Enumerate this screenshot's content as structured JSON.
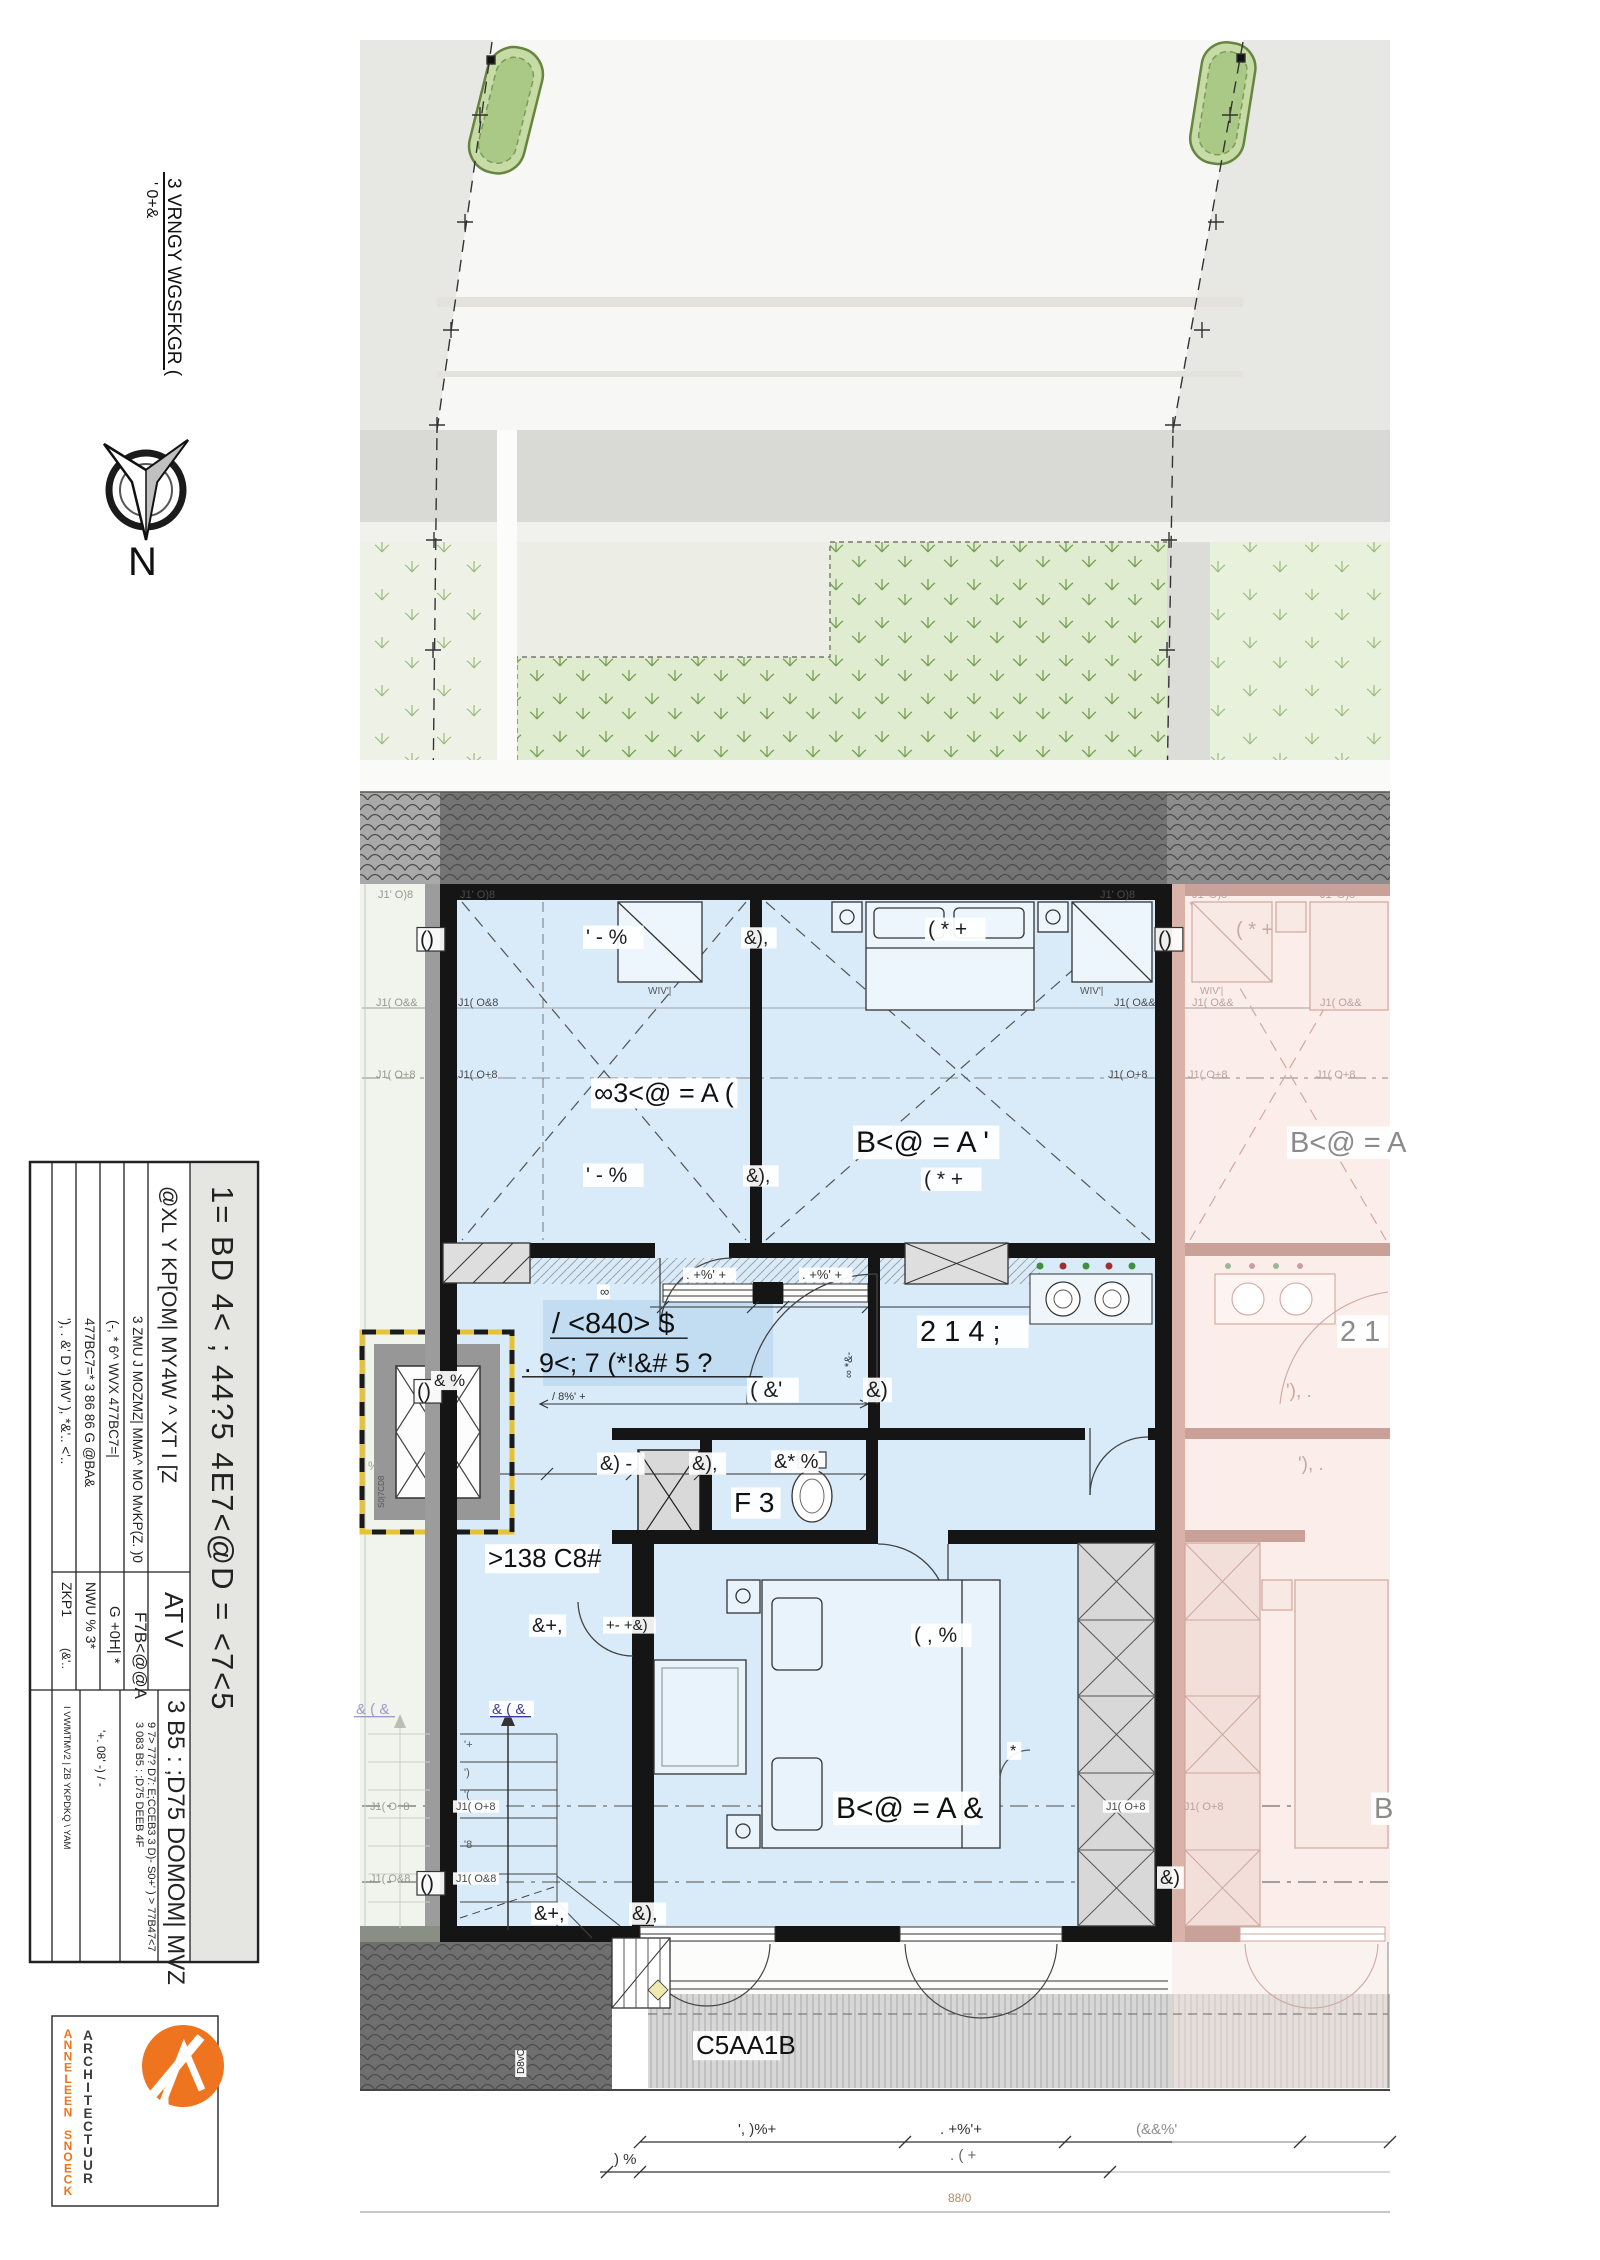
{
  "header": {
    "note1": "3 VRNGY WGSFKGR (",
    "note2": "' 0+&",
    "north_label": "N"
  },
  "colors": {
    "accent_orange": "#ee7420",
    "unit_highlight_blue": "#d9ebf9",
    "hall_highlight_blue": "#c2ddf2",
    "neighbor_pink": "#fbeeea",
    "garden_green": "#dfecd0",
    "dim_blue": "#3a3a9c"
  },
  "title_block": {
    "project_title": "1= BD 4< ;  44?5 4E7<@D = <7<5",
    "rows": [
      {
        "label": "@XL Y KP[OM| MY4W ^ XT I [Z",
        "value": "AT V"
      },
      {
        "label": "3 ZMU J MOZMZ| MMA^ MO MvKP(Z. )0",
        "value": "F7B<@@A"
      },
      {
        "label": "(-, * 6^ WVX  477BC7=|",
        "value": "G +0H| *"
      },
      {
        "label": "477BC7=* 3 86 86 G @BA&",
        "value": "NWU % 3*"
      },
      {
        "label": "'), . &' D ') MV' ), *&'.. <'..",
        "value": "ZKP1",
        "value2": "(&'.."
      }
    ],
    "drawing_title": "3 B5 : ;D75 DOMOM| MVZ",
    "notes": [
      "3 083 B5 : ;D75 DEEB 4F",
      "9 7> 77? D7: E;CCEB3 3 D)- S0+' ) > 77B47<7",
      "'+. 08' -) / -"
    ],
    "side_note": "I VWMTMV2 | ZB YKPDKQ \\ YAM"
  },
  "logo": {
    "studio": "ARCHITECTUUR",
    "architect": "ANNELEEN SNOECK"
  },
  "plan": {
    "annotations": [
      {
        "n": "wall-label",
        "x": 378,
        "y": 898,
        "t": "J1' O)8",
        "s": 11,
        "c": "#949a8e"
      },
      {
        "n": "wall-label",
        "x": 460,
        "y": 898,
        "t": "J1' O)8",
        "s": 11,
        "c": "#4a4a4a"
      },
      {
        "n": "wall-label",
        "x": 1100,
        "y": 898,
        "t": "J1' O)8",
        "s": 11,
        "c": "#4a4a4a"
      },
      {
        "n": "wall-label",
        "x": 1192,
        "y": 898,
        "t": "J1' O)8",
        "s": 11,
        "c": "#bca29a"
      },
      {
        "n": "wall-label",
        "x": 1320,
        "y": 898,
        "t": "J1' O)8",
        "s": 11,
        "c": "#bca29a"
      },
      {
        "n": "wall-label",
        "x": 376,
        "y": 1006,
        "t": "J1( O&&",
        "s": 11,
        "c": "#949a8e"
      },
      {
        "n": "wall-label",
        "x": 458,
        "y": 1006,
        "t": "J1( O&8",
        "s": 11,
        "c": "#4a4a4a"
      },
      {
        "n": "wall-label",
        "x": 1114,
        "y": 1006,
        "t": "J1( O&&",
        "s": 11,
        "c": "#4a4a4a"
      },
      {
        "n": "wall-label",
        "x": 1192,
        "y": 1006,
        "t": "J1( O&&",
        "s": 11,
        "c": "#bca29a"
      },
      {
        "n": "wall-label",
        "x": 1320,
        "y": 1006,
        "t": "J1( O&&",
        "s": 11,
        "c": "#bca29a"
      },
      {
        "n": "wall-label",
        "x": 376,
        "y": 1078,
        "t": "J1( O+8",
        "s": 11,
        "c": "#949a8e"
      },
      {
        "n": "wall-label",
        "x": 458,
        "y": 1078,
        "t": "J1( O+8",
        "s": 11,
        "c": "#4a4a4a"
      },
      {
        "n": "wall-label",
        "x": 1108,
        "y": 1078,
        "t": "J1( O+8",
        "s": 11,
        "c": "#4a4a4a"
      },
      {
        "n": "wall-label",
        "x": 1188,
        "y": 1078,
        "t": "J1( O+8",
        "s": 11,
        "c": "#bca29a"
      },
      {
        "n": "wall-label",
        "x": 1316,
        "y": 1078,
        "t": "J1( O+8",
        "s": 11,
        "c": "#bca29a"
      },
      {
        "n": "dim-label",
        "x": 586,
        "y": 944,
        "t": "' - %",
        "s": 21,
        "c": "#1d1d1d",
        "chip": 1
      },
      {
        "n": "dim-label",
        "x": 928,
        "y": 936,
        "t": "( * +",
        "s": 21,
        "c": "#1d1d1d",
        "chip": 1
      },
      {
        "n": "dim-label",
        "x": 1236,
        "y": 936,
        "t": "( * +",
        "s": 20,
        "c": "#c8a89f"
      },
      {
        "n": "dim-label",
        "x": 744,
        "y": 944,
        "t": "&),",
        "s": 19,
        "c": "#1d1d1d",
        "chip": 1
      },
      {
        "n": "wall-marker",
        "x": 420,
        "y": 946,
        "t": "()",
        "s": 21,
        "c": "#1d1d1d",
        "chip": 1,
        "box": 1
      },
      {
        "n": "wall-marker",
        "x": 417,
        "y": 1398,
        "t": "()",
        "s": 21,
        "c": "#1d1d1d",
        "chip": 1,
        "box": 1
      },
      {
        "n": "wall-marker",
        "x": 420,
        "y": 1890,
        "t": "()",
        "s": 21,
        "c": "#1d1d1d",
        "chip": 1,
        "box": 1
      },
      {
        "n": "wall-marker",
        "x": 1158,
        "y": 946,
        "t": "()",
        "s": 21,
        "c": "#1d1d1d",
        "chip": 1,
        "box": 1
      },
      {
        "n": "room-label",
        "x": 594,
        "y": 1102,
        "t": "∞3<@ = A (",
        "s": 27,
        "c": "#111",
        "chip": 1
      },
      {
        "n": "room-label",
        "x": 856,
        "y": 1152,
        "t": "B<@ = A '",
        "s": 30,
        "c": "#111",
        "chip": 1
      },
      {
        "n": "dim-label",
        "x": 924,
        "y": 1186,
        "t": "( * +",
        "s": 21,
        "c": "#1d1d1d",
        "chip": 1
      },
      {
        "n": "dim-label",
        "x": 586,
        "y": 1182,
        "t": "' - %",
        "s": 21,
        "c": "#1d1d1d",
        "chip": 1
      },
      {
        "n": "dim-label",
        "x": 746,
        "y": 1182,
        "t": "&),",
        "s": 19,
        "c": "#1d1d1d",
        "chip": 1
      },
      {
        "n": "room-label",
        "x": 1290,
        "y": 1152,
        "t": "B<@ = A",
        "s": 29,
        "c": "#8b8b8b",
        "chip": 1
      },
      {
        "n": "closet-label",
        "x": 648,
        "y": 994,
        "t": "WIV'|",
        "s": 10,
        "c": "#555"
      },
      {
        "n": "closet-label",
        "x": 1080,
        "y": 994,
        "t": "WIV'|",
        "s": 10,
        "c": "#555"
      },
      {
        "n": "closet-label",
        "x": 1200,
        "y": 994,
        "t": "WIV'|",
        "s": 10,
        "c": "#bca29a"
      },
      {
        "n": "dim-label",
        "x": 686,
        "y": 1279,
        "t": ". +%' +",
        "s": 13,
        "c": "#333",
        "chip": 1
      },
      {
        "n": "dim-label",
        "x": 802,
        "y": 1279,
        "t": ". +%' +",
        "s": 13,
        "c": "#333",
        "chip": 1
      },
      {
        "n": "wall-marker",
        "x": 600,
        "y": 1296,
        "t": "∞",
        "s": 13,
        "c": "#333",
        "chip": 1
      },
      {
        "n": "room-label",
        "x": 552,
        "y": 1333,
        "t": "/ <840> $",
        "s": 29,
        "c": "#111",
        "u": 1
      },
      {
        "n": "room-label",
        "x": 524,
        "y": 1372,
        "t": ". 9<; 7 (*!&# 5 ?",
        "s": 27,
        "c": "#111",
        "u": 1
      },
      {
        "n": "hall-small",
        "x": 552,
        "y": 1400,
        "t": "/ 8%' +",
        "s": 11,
        "c": "#333"
      },
      {
        "n": "room-label",
        "x": 920,
        "y": 1341,
        "t": "2 1 4 ;",
        "s": 29,
        "c": "#111",
        "chip": 1
      },
      {
        "n": "room-label",
        "x": 1340,
        "y": 1341,
        "t": "2 1",
        "s": 29,
        "c": "#8b8b8b",
        "chip": 1
      },
      {
        "n": "dim-label",
        "x": 750,
        "y": 1397,
        "t": "( &'",
        "s": 22,
        "c": "#1d1d1d",
        "chip": 1
      },
      {
        "n": "dim-label",
        "x": 866,
        "y": 1397,
        "t": "&)",
        "s": 22,
        "c": "#1d1d1d",
        "chip": 1
      },
      {
        "n": "dim-label",
        "x": 852,
        "y": 1378,
        "t": "∞ *&-",
        "s": 11,
        "c": "#333",
        "r": -90
      },
      {
        "n": "dim-label",
        "x": 1286,
        "y": 1397,
        "t": "'), .",
        "s": 19,
        "c": "#c8a89f"
      },
      {
        "n": "shaft-label",
        "x": 434,
        "y": 1386,
        "t": "& %",
        "s": 17,
        "c": "#1d1d1d",
        "chip": 1
      },
      {
        "n": "room-label",
        "x": 734,
        "y": 1512,
        "t": "F 3",
        "s": 28,
        "c": "#111",
        "chip": 1
      },
      {
        "n": "dim-label",
        "x": 600,
        "y": 1470,
        "t": "&) -",
        "s": 20,
        "c": "#1d1d1d",
        "chip": 1
      },
      {
        "n": "dim-label",
        "x": 692,
        "y": 1470,
        "t": "&),",
        "s": 20,
        "c": "#1d1d1d",
        "chip": 1
      },
      {
        "n": "dim-label",
        "x": 774,
        "y": 1468,
        "t": "&* %",
        "s": 20,
        "c": "#1d1d1d",
        "chip": 1
      },
      {
        "n": "dim-label",
        "x": 1298,
        "y": 1470,
        "t": "'), .",
        "s": 19,
        "c": "#c8a89f"
      },
      {
        "n": "room-label",
        "x": 488,
        "y": 1567,
        "t": ">138 C8#",
        "s": 26,
        "c": "#111",
        "chip": 1
      },
      {
        "n": "dim-label",
        "x": 532,
        "y": 1632,
        "t": "&+,",
        "s": 20,
        "c": "#1d1d1d",
        "chip": 1
      },
      {
        "n": "dim-label",
        "x": 606,
        "y": 1630,
        "t": "+- +&)",
        "s": 15,
        "c": "#1d1d1d",
        "chip": 1
      },
      {
        "n": "dim-label",
        "x": 914,
        "y": 1642,
        "t": "( , %",
        "s": 21,
        "c": "#1d1d1d",
        "chip": 1
      },
      {
        "n": "room-label",
        "x": 836,
        "y": 1818,
        "t": "B<@ = A &",
        "s": 30,
        "c": "#111",
        "chip": 1
      },
      {
        "n": "room-label",
        "x": 1374,
        "y": 1818,
        "t": "B",
        "s": 29,
        "c": "#8b8b8b",
        "chip": 1
      },
      {
        "n": "stair-label",
        "x": 492,
        "y": 1714,
        "t": "& ( &",
        "s": 15,
        "c": "#3a3a9c",
        "u": 1,
        "chip": 1
      },
      {
        "n": "stair-label",
        "x": 356,
        "y": 1714,
        "t": "& ( &",
        "s": 15,
        "c": "#9c9cc6",
        "u": 1
      },
      {
        "n": "tread-label",
        "x": 464,
        "y": 1748,
        "t": "'+",
        "s": 11,
        "c": "#555"
      },
      {
        "n": "tread-label",
        "x": 464,
        "y": 1776,
        "t": "')",
        "s": 11,
        "c": "#555"
      },
      {
        "n": "tread-label",
        "x": 464,
        "y": 1798,
        "t": "'(",
        "s": 11,
        "c": "#555"
      },
      {
        "n": "wall-label",
        "x": 456,
        "y": 1810,
        "t": "J1( O+8",
        "s": 11,
        "c": "#4a4a4a",
        "chip": 1
      },
      {
        "n": "tread-label",
        "x": 464,
        "y": 1848,
        "t": "'8",
        "s": 11,
        "c": "#555"
      },
      {
        "n": "wall-label",
        "x": 456,
        "y": 1882,
        "t": "J1( O&8",
        "s": 11,
        "c": "#4a4a4a",
        "chip": 1
      },
      {
        "n": "wall-label",
        "x": 370,
        "y": 1810,
        "t": "J1( O+8",
        "s": 11,
        "c": "#9aa094"
      },
      {
        "n": "wall-label",
        "x": 370,
        "y": 1882,
        "t": "J1( O&8",
        "s": 11,
        "c": "#9aa094"
      },
      {
        "n": "wall-label",
        "x": 1106,
        "y": 1810,
        "t": "J1( O+8",
        "s": 11,
        "c": "#4a4a4a",
        "chip": 1
      },
      {
        "n": "wall-label",
        "x": 1184,
        "y": 1810,
        "t": "J1( O+8",
        "s": 11,
        "c": "#bca29a"
      },
      {
        "n": "dim-label",
        "x": 1010,
        "y": 1756,
        "t": "*",
        "s": 16,
        "c": "#1d1d1d",
        "chip": 1
      },
      {
        "n": "dim-label",
        "x": 534,
        "y": 1920,
        "t": "&+,",
        "s": 20,
        "c": "#1d1d1d",
        "chip": 1
      },
      {
        "n": "dim-label",
        "x": 632,
        "y": 1920,
        "t": "&),",
        "s": 20,
        "c": "#1d1d1d",
        "chip": 1
      },
      {
        "n": "dim-label",
        "x": 1160,
        "y": 1884,
        "t": "&)",
        "s": 20,
        "c": "#1d1d1d",
        "chip": 1
      },
      {
        "n": "terrace-label",
        "x": 696,
        "y": 2054,
        "t": "C5AA1B",
        "s": 26,
        "c": "#111",
        "chip": 1
      },
      {
        "n": "terrace-label",
        "x": 524,
        "y": 2074,
        "t": "D8vC",
        "s": 10,
        "c": "#222",
        "r": -90,
        "chip": 1
      },
      {
        "n": "dim-label",
        "x": 738,
        "y": 2134,
        "t": "', )%+",
        "s": 15,
        "c": "#333"
      },
      {
        "n": "dim-label",
        "x": 940,
        "y": 2134,
        "t": ". +%'+",
        "s": 15,
        "c": "#333"
      },
      {
        "n": "dim-label",
        "x": 1136,
        "y": 2134,
        "t": "(&&%'",
        "s": 15,
        "c": "#8d8d8d"
      },
      {
        "n": "dim-label",
        "x": 614,
        "y": 2164,
        "t": ") %",
        "s": 15,
        "c": "#333"
      },
      {
        "n": "dim-label",
        "x": 950,
        "y": 2160,
        "t": ". ( +",
        "s": 15,
        "c": "#666"
      },
      {
        "n": "dim-label",
        "x": 948,
        "y": 2202,
        "t": "88/0",
        "s": 12,
        "c": "#b58c62"
      },
      {
        "n": "wall-label",
        "x": 368,
        "y": 1470,
        "t": "%",
        "s": 12,
        "c": "#9aa094"
      },
      {
        "n": "shaft-label",
        "x": 384,
        "y": 1508,
        "t": "S0|7CD8",
        "s": 8,
        "c": "#555",
        "r": -90
      }
    ]
  }
}
